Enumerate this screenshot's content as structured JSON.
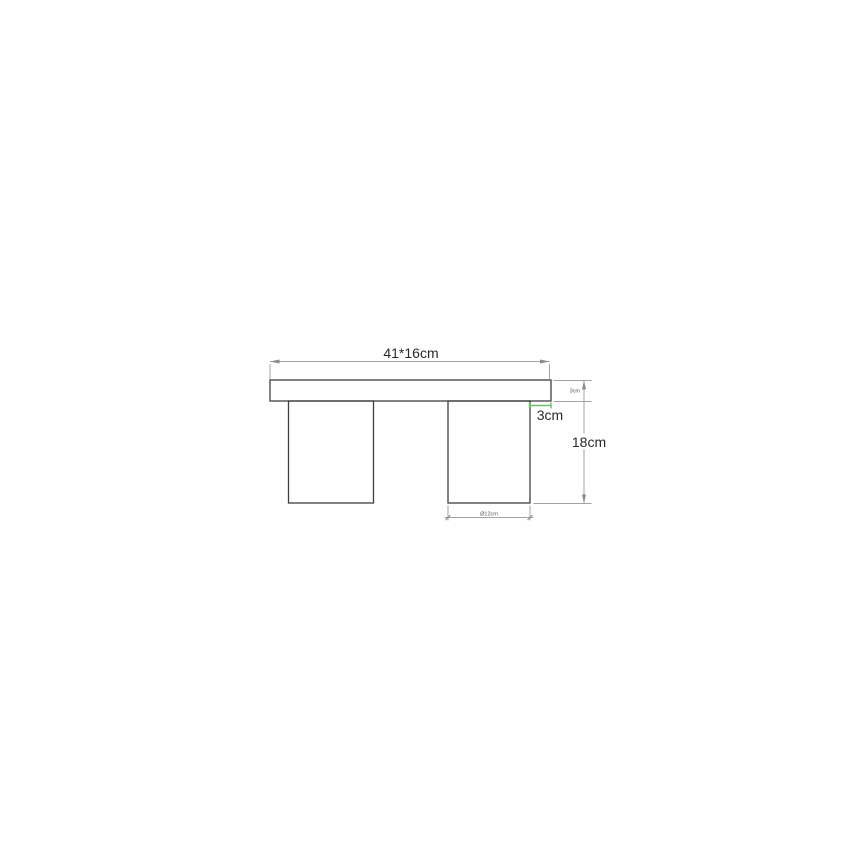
{
  "page": {
    "background": "#ffffff"
  },
  "drawing": {
    "labels": {
      "top_dimension": "41*16cm",
      "overhang": "3cm",
      "total_height": "18cm",
      "top_thickness": "3cm",
      "leg_width": "Ø12cm"
    },
    "colors": {
      "outline": "#3f3f3f",
      "hatch": "#6e6e6e",
      "dimension_line": "#a3a3a3",
      "label_text": "#2a2a2a",
      "accent_green": "#6abf69"
    }
  }
}
